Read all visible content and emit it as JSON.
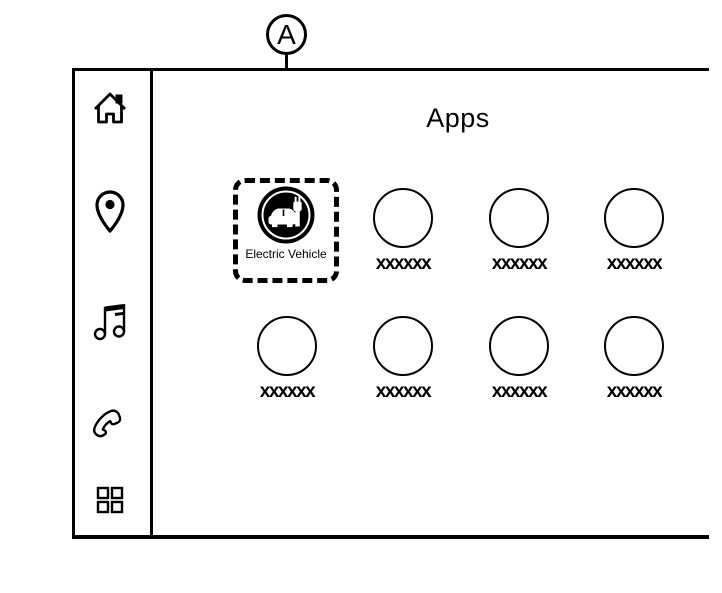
{
  "figure": {
    "callout_label": "A"
  },
  "screen": {
    "title": "Apps",
    "sidebar": {
      "items": [
        {
          "id": "home",
          "icon": "home-icon"
        },
        {
          "id": "navigation",
          "icon": "location-pin-icon"
        },
        {
          "id": "audio",
          "icon": "music-note-icon"
        },
        {
          "id": "phone",
          "icon": "phone-handset-icon"
        },
        {
          "id": "apps",
          "icon": "apps-grid-icon"
        }
      ]
    },
    "apps_grid": {
      "highlighted_app": {
        "label": "Electric Vehicle",
        "icon": "electric-vehicle-icon"
      },
      "placeholder_apps": [
        "xxxxxx",
        "xxxxxx",
        "xxxxxx",
        "xxxxxx",
        "xxxxxx",
        "xxxxxx",
        "xxxxxx"
      ]
    }
  },
  "colors": {
    "ink": "#000000",
    "background": "#ffffff"
  }
}
